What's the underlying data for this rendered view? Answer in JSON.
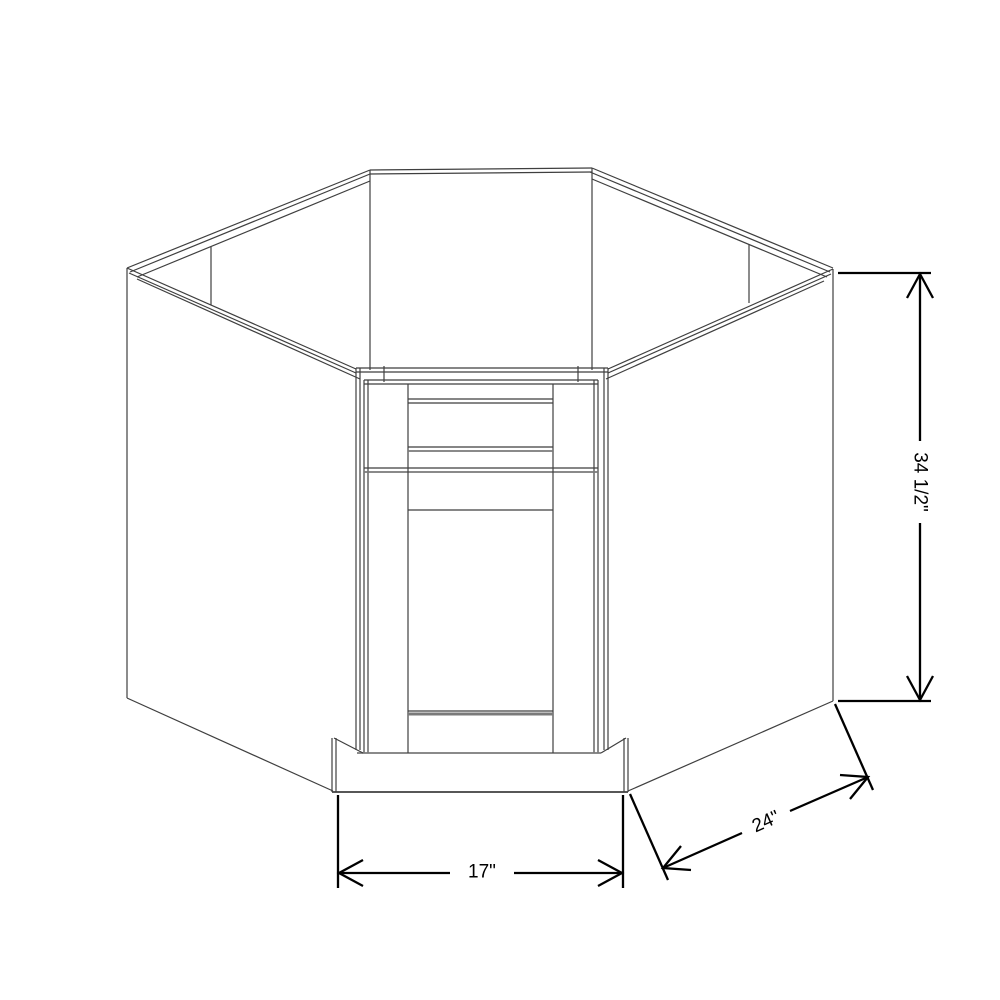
{
  "drawing": {
    "subject": "diagonal-corner-sink-base-cabinet",
    "colors": {
      "background": "#ffffff",
      "outline": "#3f3f3f",
      "outline-light": "#7a7a7a",
      "dimension": "#000000"
    },
    "dimensions": {
      "height": {
        "label": "34 1/2\""
      },
      "depth": {
        "label": "24\""
      },
      "front_width": {
        "label": "17\""
      }
    }
  }
}
